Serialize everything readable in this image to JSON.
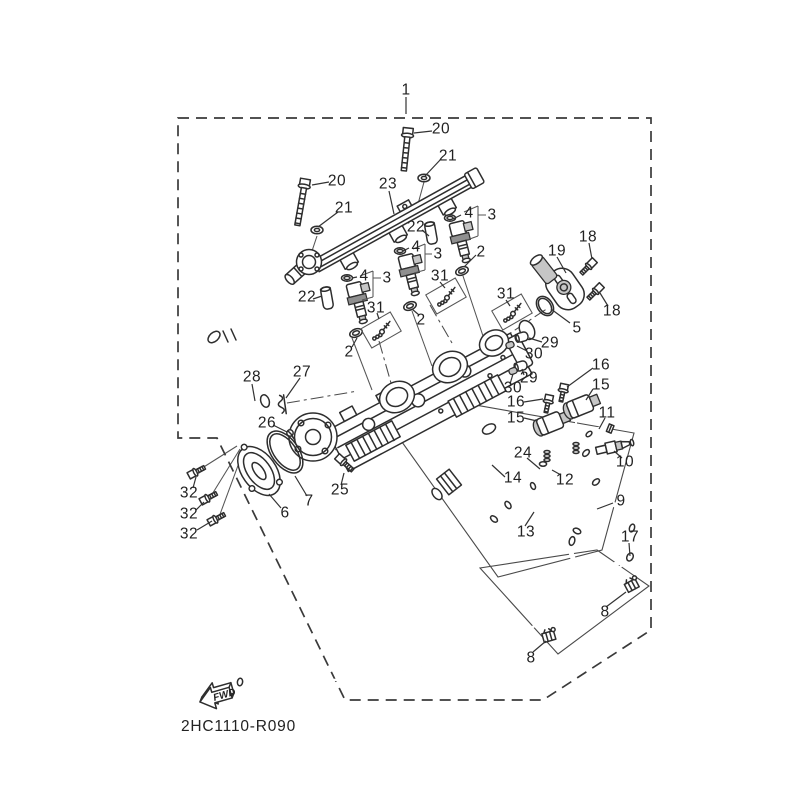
{
  "diagram": {
    "code": "2HC1110-R090",
    "fwd_label": "FWD",
    "assembly_ref": "1"
  },
  "colors": {
    "background": "#ffffff",
    "line": "#2e2e2e",
    "label_text": "#222222"
  },
  "labels": [
    {
      "t": "1",
      "x": 406,
      "y": 90
    },
    {
      "t": "20",
      "x": 441,
      "y": 129
    },
    {
      "t": "21",
      "x": 448,
      "y": 156
    },
    {
      "t": "20",
      "x": 337,
      "y": 181
    },
    {
      "t": "23",
      "x": 388,
      "y": 184
    },
    {
      "t": "21",
      "x": 344,
      "y": 208
    },
    {
      "t": "4",
      "x": 469,
      "y": 213
    },
    {
      "t": "3",
      "x": 492,
      "y": 215
    },
    {
      "t": "22",
      "x": 416,
      "y": 227
    },
    {
      "t": "4",
      "x": 416,
      "y": 247
    },
    {
      "t": "3",
      "x": 438,
      "y": 254
    },
    {
      "t": "2",
      "x": 481,
      "y": 252
    },
    {
      "t": "19",
      "x": 557,
      "y": 251
    },
    {
      "t": "18",
      "x": 588,
      "y": 237
    },
    {
      "t": "4",
      "x": 364,
      "y": 276
    },
    {
      "t": "3",
      "x": 387,
      "y": 278
    },
    {
      "t": "31",
      "x": 440,
      "y": 276
    },
    {
      "t": "22",
      "x": 307,
      "y": 297
    },
    {
      "t": "31",
      "x": 506,
      "y": 294
    },
    {
      "t": "18",
      "x": 612,
      "y": 311
    },
    {
      "t": "31",
      "x": 376,
      "y": 308
    },
    {
      "t": "2",
      "x": 421,
      "y": 320
    },
    {
      "t": "5",
      "x": 577,
      "y": 328
    },
    {
      "t": "29",
      "x": 550,
      "y": 343
    },
    {
      "t": "30",
      "x": 534,
      "y": 354
    },
    {
      "t": "2",
      "x": 349,
      "y": 352
    },
    {
      "t": "16",
      "x": 601,
      "y": 365
    },
    {
      "t": "15",
      "x": 601,
      "y": 385
    },
    {
      "t": "28",
      "x": 252,
      "y": 377
    },
    {
      "t": "27",
      "x": 302,
      "y": 372
    },
    {
      "t": "29",
      "x": 529,
      "y": 378
    },
    {
      "t": "30",
      "x": 513,
      "y": 388
    },
    {
      "t": "16",
      "x": 516,
      "y": 402
    },
    {
      "t": "26",
      "x": 267,
      "y": 423
    },
    {
      "t": "15",
      "x": 516,
      "y": 418
    },
    {
      "t": "11",
      "x": 607,
      "y": 413
    },
    {
      "t": "24",
      "x": 523,
      "y": 453
    },
    {
      "t": "10",
      "x": 625,
      "y": 462
    },
    {
      "t": "14",
      "x": 513,
      "y": 478
    },
    {
      "t": "12",
      "x": 565,
      "y": 480
    },
    {
      "t": "32",
      "x": 189,
      "y": 493
    },
    {
      "t": "25",
      "x": 340,
      "y": 490
    },
    {
      "t": "7",
      "x": 309,
      "y": 501
    },
    {
      "t": "32",
      "x": 189,
      "y": 514
    },
    {
      "t": "6",
      "x": 285,
      "y": 513
    },
    {
      "t": "9",
      "x": 621,
      "y": 501
    },
    {
      "t": "13",
      "x": 526,
      "y": 532
    },
    {
      "t": "32",
      "x": 189,
      "y": 534
    },
    {
      "t": "17",
      "x": 630,
      "y": 537
    },
    {
      "t": "8",
      "x": 605,
      "y": 612
    },
    {
      "t": "8",
      "x": 531,
      "y": 658
    }
  ],
  "leaders": [
    {
      "x1": 406,
      "y1": 97,
      "x2": 406,
      "y2": 114
    },
    {
      "x1": 432,
      "y1": 131,
      "x2": 414,
      "y2": 133
    },
    {
      "x1": 441,
      "y1": 159,
      "x2": 425,
      "y2": 176
    },
    {
      "x1": 329,
      "y1": 182,
      "x2": 312,
      "y2": 185
    },
    {
      "x1": 389,
      "y1": 191,
      "x2": 394,
      "y2": 214
    },
    {
      "x1": 338,
      "y1": 212,
      "x2": 318,
      "y2": 227
    },
    {
      "x1": 461,
      "y1": 215,
      "x2": 453,
      "y2": 219
    },
    {
      "x1": 422,
      "y1": 230,
      "x2": 429,
      "y2": 236
    },
    {
      "x1": 409,
      "y1": 248,
      "x2": 403,
      "y2": 251
    },
    {
      "x1": 476,
      "y1": 255,
      "x2": 464,
      "y2": 267
    },
    {
      "x1": 557,
      "y1": 257,
      "x2": 566,
      "y2": 273
    },
    {
      "x1": 589,
      "y1": 243,
      "x2": 592,
      "y2": 259
    },
    {
      "x1": 357,
      "y1": 277,
      "x2": 352,
      "y2": 278
    },
    {
      "x1": 440,
      "y1": 282,
      "x2": 445,
      "y2": 288
    },
    {
      "x1": 313,
      "y1": 299,
      "x2": 322,
      "y2": 296
    },
    {
      "x1": 506,
      "y1": 300,
      "x2": 510,
      "y2": 306
    },
    {
      "x1": 608,
      "y1": 306,
      "x2": 600,
      "y2": 293
    },
    {
      "x1": 377,
      "y1": 313,
      "x2": 379,
      "y2": 319
    },
    {
      "x1": 419,
      "y1": 315,
      "x2": 412,
      "y2": 309
    },
    {
      "x1": 570,
      "y1": 323,
      "x2": 551,
      "y2": 309
    },
    {
      "x1": 542,
      "y1": 342,
      "x2": 529,
      "y2": 338
    },
    {
      "x1": 527,
      "y1": 351,
      "x2": 517,
      "y2": 346
    },
    {
      "x1": 352,
      "y1": 347,
      "x2": 357,
      "y2": 338
    },
    {
      "x1": 593,
      "y1": 368,
      "x2": 567,
      "y2": 387
    },
    {
      "x1": 593,
      "y1": 389,
      "x2": 586,
      "y2": 400
    },
    {
      "x1": 252,
      "y1": 384,
      "x2": 255,
      "y2": 401
    },
    {
      "x1": 300,
      "y1": 378,
      "x2": 286,
      "y2": 398
    },
    {
      "x1": 524,
      "y1": 375,
      "x2": 522,
      "y2": 369
    },
    {
      "x1": 510,
      "y1": 384,
      "x2": 513,
      "y2": 374
    },
    {
      "x1": 524,
      "y1": 402,
      "x2": 543,
      "y2": 399
    },
    {
      "x1": 273,
      "y1": 425,
      "x2": 287,
      "y2": 432
    },
    {
      "x1": 524,
      "y1": 418,
      "x2": 537,
      "y2": 421
    },
    {
      "x1": 605,
      "y1": 418,
      "x2": 599,
      "y2": 429
    },
    {
      "x1": 527,
      "y1": 458,
      "x2": 540,
      "y2": 469
    },
    {
      "x1": 622,
      "y1": 458,
      "x2": 614,
      "y2": 451
    },
    {
      "x1": 505,
      "y1": 477,
      "x2": 492,
      "y2": 465
    },
    {
      "x1": 561,
      "y1": 475,
      "x2": 552,
      "y2": 470
    },
    {
      "x1": 193,
      "y1": 488,
      "x2": 196,
      "y2": 477
    },
    {
      "x1": 341,
      "y1": 485,
      "x2": 344,
      "y2": 473
    },
    {
      "x1": 307,
      "y1": 496,
      "x2": 295,
      "y2": 476
    },
    {
      "x1": 196,
      "y1": 510,
      "x2": 204,
      "y2": 502
    },
    {
      "x1": 281,
      "y1": 508,
      "x2": 269,
      "y2": 494
    },
    {
      "x1": 613,
      "y1": 503,
      "x2": 597,
      "y2": 509
    },
    {
      "x1": 525,
      "y1": 526,
      "x2": 534,
      "y2": 512
    },
    {
      "x1": 197,
      "y1": 530,
      "x2": 212,
      "y2": 521
    },
    {
      "x1": 629,
      "y1": 543,
      "x2": 630,
      "y2": 556
    },
    {
      "x1": 606,
      "y1": 607,
      "x2": 626,
      "y2": 592
    },
    {
      "x1": 533,
      "y1": 652,
      "x2": 546,
      "y2": 641
    }
  ]
}
